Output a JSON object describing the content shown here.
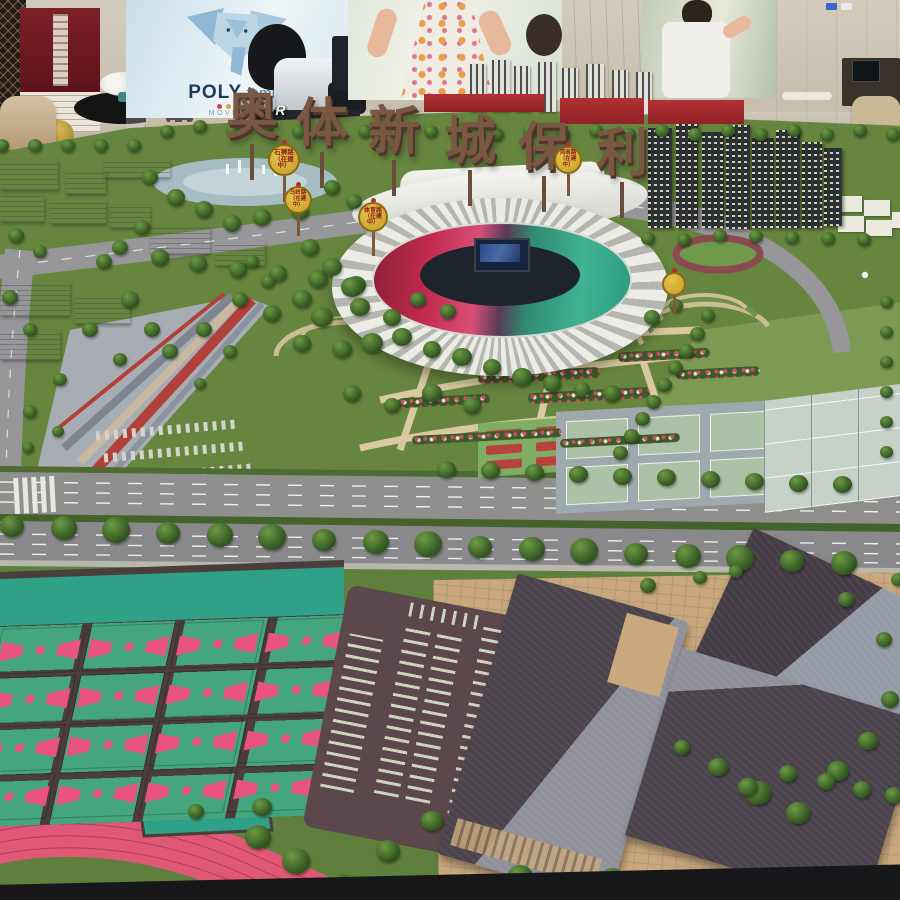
{
  "interior": {
    "brand": "POLY",
    "brand_suffix": "family",
    "brand_dots_colors": [
      "#c94a3a",
      "#d9a43a",
      "#4a88c9",
      "#52a862",
      "#8a62c9"
    ],
    "tagline": "MOVE THE",
    "vr_label": "VR"
  },
  "model": {
    "title_characters": [
      "奥",
      "体",
      "新",
      "城",
      "保",
      "利"
    ],
    "road_signs": [
      {
        "name": "石狮路",
        "status": "（在建中）"
      },
      {
        "name": "马岭路",
        "status": "（在建中）"
      },
      {
        "name": "体育路",
        "status": "（在建中）"
      },
      {
        "name": "鸿商路",
        "status": "（在建中）"
      }
    ],
    "colors": {
      "grass": "#66853F",
      "court_green": "#44A57F",
      "court_pink": "#E8537F",
      "tennis_blue": "#8792C2",
      "sign_yellow": "#D9B53A",
      "stadium_red": "#C72B50",
      "stadium_teal": "#41B894",
      "roof_dark": "#4A434B",
      "brick": "#C9A87E",
      "track_pink": "#DF5977"
    }
  }
}
